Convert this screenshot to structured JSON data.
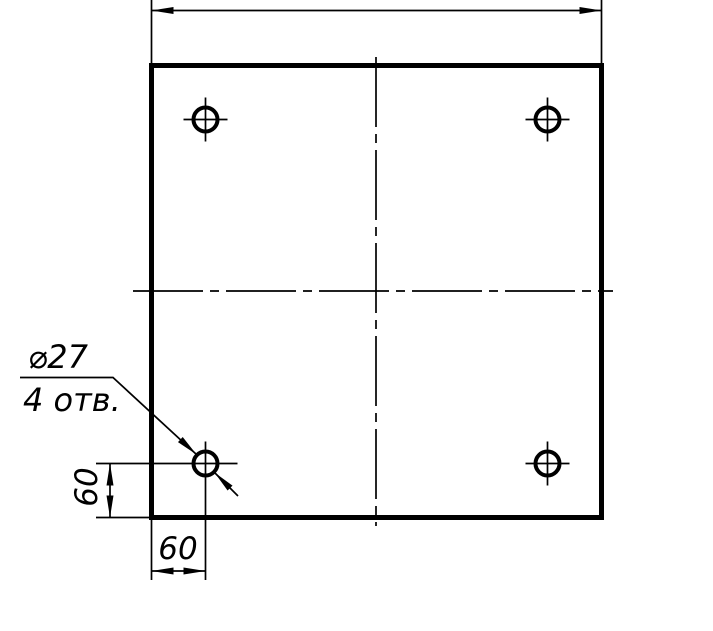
{
  "drawing": {
    "kind": "technical-drawing-plate-with-holes",
    "callout": {
      "diameter": "⌀27",
      "hole_count": "4 отв."
    },
    "dimensions": {
      "hole_offset_left_vertical": "60",
      "hole_offset_bottom_horizontal": "60"
    },
    "colors": {
      "line": "#000000",
      "background": "#ffffff"
    }
  }
}
